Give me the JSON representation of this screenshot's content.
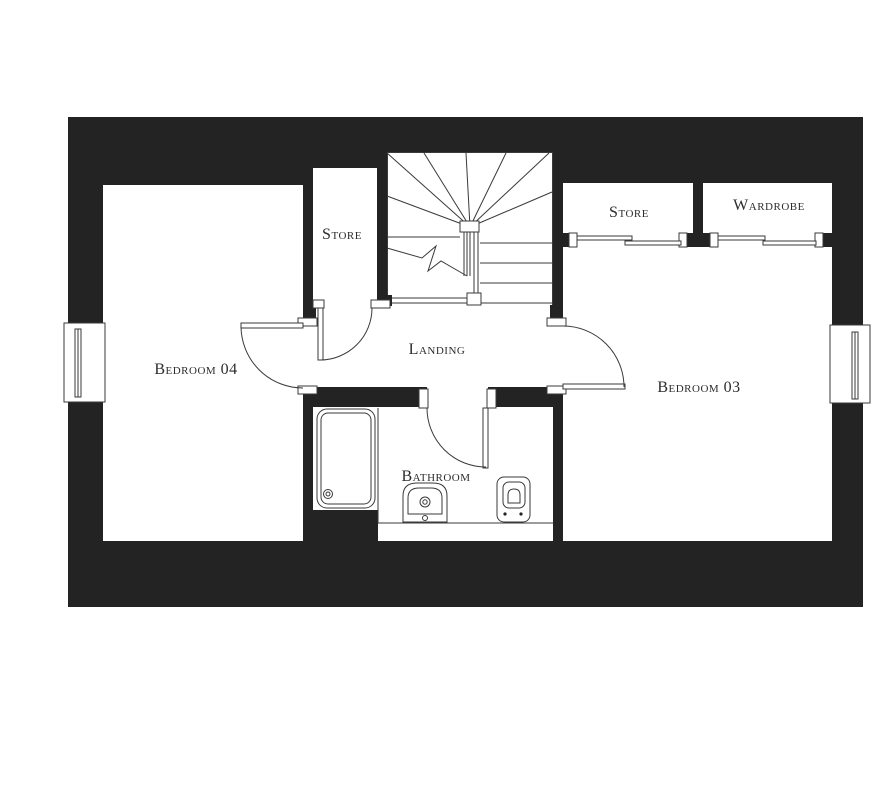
{
  "plan": {
    "floor_labels": {
      "bedroom04": "Bedroom 04",
      "bedroom03": "Bedroom 03",
      "landing": "Landing",
      "bathroom": "Bathroom",
      "store_inner": "Store",
      "store_bedroom": "Store",
      "wardrobe": "Wardrobe"
    },
    "fixtures": [
      "staircase",
      "bathtub",
      "washbasin",
      "toilet"
    ],
    "windows_count": 2,
    "doors": {
      "hinged": 4,
      "sliding": 2
    },
    "colors": {
      "wall": "#232323",
      "line": "#3a3a3a",
      "text": "#2e2b2c",
      "background": "#ffffff"
    }
  }
}
